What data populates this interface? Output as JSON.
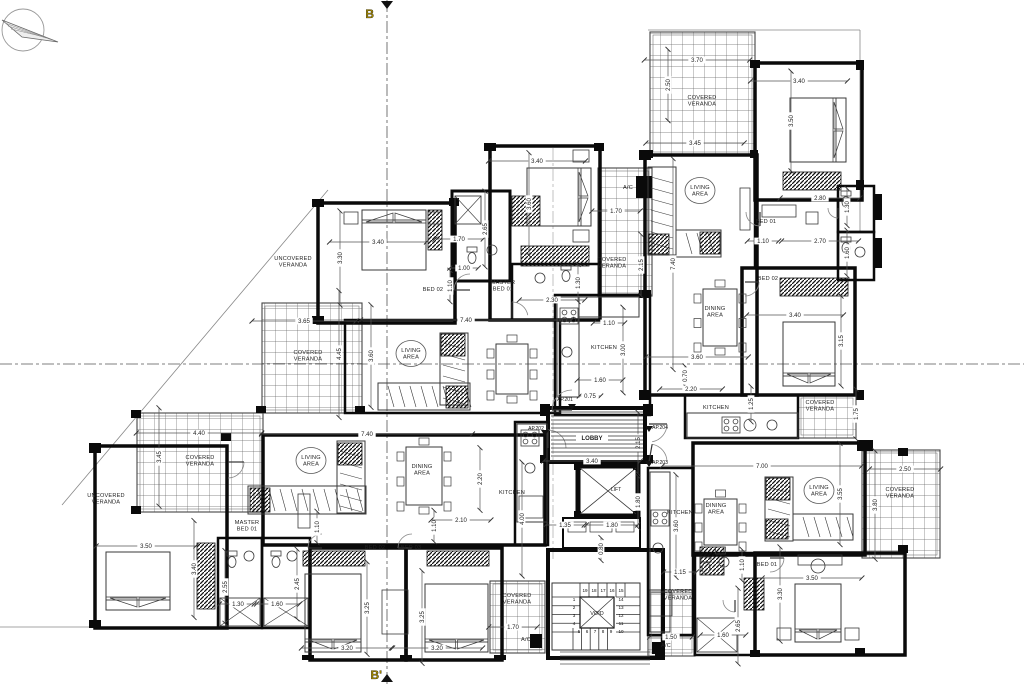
{
  "drawing": {
    "type": "apartment-building-floor-plan",
    "colors": {
      "paper": "#ffffff",
      "wall": "#0a0a0a",
      "furniture": "#3a3a3a",
      "grid": "#666666",
      "dim_line": "#555555",
      "label": "#222222",
      "section_marker": "#a58a00"
    },
    "section": {
      "top": "B",
      "bottom": "B'"
    },
    "compass": {
      "name": "north-arrow"
    },
    "core": {
      "lobby": "LOBBY",
      "lift": "LIFT",
      "void": "VOID"
    },
    "stair_steps": [
      {
        "n": "1",
        "x": 574,
        "y": 601
      },
      {
        "n": "2",
        "x": 574,
        "y": 609
      },
      {
        "n": "3",
        "x": 574,
        "y": 617
      },
      {
        "n": "4",
        "x": 574,
        "y": 625
      },
      {
        "n": "5",
        "x": 579,
        "y": 633
      },
      {
        "n": "6",
        "x": 587,
        "y": 633
      },
      {
        "n": "7",
        "x": 595,
        "y": 633
      },
      {
        "n": "8",
        "x": 603,
        "y": 633
      },
      {
        "n": "9",
        "x": 611,
        "y": 633
      },
      {
        "n": "10",
        "x": 621,
        "y": 633
      },
      {
        "n": "11",
        "x": 621,
        "y": 625
      },
      {
        "n": "12",
        "x": 621,
        "y": 617
      },
      {
        "n": "13",
        "x": 621,
        "y": 609
      },
      {
        "n": "14",
        "x": 621,
        "y": 601
      },
      {
        "n": "15",
        "x": 621,
        "y": 592
      },
      {
        "n": "16",
        "x": 612,
        "y": 592
      },
      {
        "n": "17",
        "x": 603,
        "y": 592
      },
      {
        "n": "18",
        "x": 594,
        "y": 592
      },
      {
        "n": "19",
        "x": 585,
        "y": 592
      }
    ],
    "apartment_doors": [
      {
        "t": "AP.201",
        "x": 565,
        "y": 401,
        "mx": 572,
        "my": 404
      },
      {
        "t": "AP.202",
        "x": 536,
        "y": 430,
        "mx": 545,
        "my": 430
      },
      {
        "t": "AP.204",
        "x": 660,
        "y": 429,
        "mx": 649,
        "my": 426
      },
      {
        "t": "AP.203",
        "x": 660,
        "y": 464,
        "mx": 649,
        "my": 461
      }
    ],
    "room_labels": [
      {
        "lines": [
          "UNCOVERED",
          "VERANDA"
        ],
        "x": 293,
        "y": 260
      },
      {
        "lines": [
          "COVERED",
          "VERANDA"
        ],
        "x": 308,
        "y": 354
      },
      {
        "lines": [
          "LIVING",
          "AREA"
        ],
        "x": 411,
        "y": 352,
        "oval": true
      },
      {
        "lines": [
          "MASTER",
          "BED 01"
        ],
        "x": 503,
        "y": 284
      },
      {
        "lines": [
          "BED 02"
        ],
        "x": 433,
        "y": 291
      },
      {
        "lines": [
          "COVERED",
          "VERANDA"
        ],
        "x": 612,
        "y": 261
      },
      {
        "lines": [
          "A/C"
        ],
        "x": 628,
        "y": 189
      },
      {
        "lines": [
          "COVERED",
          "VERANDA"
        ],
        "x": 702,
        "y": 99
      },
      {
        "lines": [
          "LIVING",
          "AREA"
        ],
        "x": 700,
        "y": 189,
        "oval": true
      },
      {
        "lines": [
          "BED 01"
        ],
        "x": 766,
        "y": 223
      },
      {
        "lines": [
          "BED 02"
        ],
        "x": 768,
        "y": 280
      },
      {
        "lines": [
          "DINING",
          "AREA"
        ],
        "x": 715,
        "y": 310
      },
      {
        "lines": [
          "KITCHEN"
        ],
        "x": 716,
        "y": 409
      },
      {
        "lines": [
          "COVERED",
          "VERANDA"
        ],
        "x": 820,
        "y": 404
      },
      {
        "lines": [
          "KITCHEN"
        ],
        "x": 604,
        "y": 349
      },
      {
        "lines": [
          "MASTER",
          "BED 01"
        ],
        "x": 247,
        "y": 524
      },
      {
        "lines": [
          "COVERED",
          "VERANDA"
        ],
        "x": 200,
        "y": 459
      },
      {
        "lines": [
          "UNCOVERED",
          "VERANDA"
        ],
        "x": 106,
        "y": 497
      },
      {
        "lines": [
          "LIVING",
          "AREA"
        ],
        "x": 311,
        "y": 459,
        "oval": true
      },
      {
        "lines": [
          "DINING",
          "AREA"
        ],
        "x": 422,
        "y": 468
      },
      {
        "lines": [
          "KITCHEN"
        ],
        "x": 512,
        "y": 494
      },
      {
        "lines": [
          "BED 02"
        ],
        "x": 375,
        "y": 549
      },
      {
        "lines": [
          "BED 03"
        ],
        "x": 411,
        "y": 549
      },
      {
        "lines": [
          "KITCHEN"
        ],
        "x": 680,
        "y": 514
      },
      {
        "lines": [
          "DINING",
          "AREA"
        ],
        "x": 716,
        "y": 507
      },
      {
        "lines": [
          "LIVING",
          "AREA"
        ],
        "x": 819,
        "y": 489,
        "oval": true
      },
      {
        "lines": [
          "BED 01"
        ],
        "x": 767,
        "y": 566
      },
      {
        "lines": [
          "COVERED",
          "VERANDA"
        ],
        "x": 678,
        "y": 593
      },
      {
        "lines": [
          "COVERED",
          "VERANDA"
        ],
        "x": 517,
        "y": 597
      },
      {
        "lines": [
          "COVERED",
          "VERANDA"
        ],
        "x": 900,
        "y": 491
      },
      {
        "lines": [
          "A/C"
        ],
        "x": 666,
        "y": 647
      },
      {
        "lines": [
          "A/C"
        ],
        "x": 526,
        "y": 641
      }
    ],
    "dimensions": [
      {
        "t": "3.40",
        "x": 378,
        "y": 242
      },
      {
        "t": "3.30",
        "x": 340,
        "y": 258,
        "v": 1
      },
      {
        "t": "1.70",
        "x": 459,
        "y": 239
      },
      {
        "t": "2.65",
        "x": 485,
        "y": 229,
        "v": 1
      },
      {
        "t": "1.00",
        "x": 464,
        "y": 268
      },
      {
        "t": "1.10",
        "x": 450,
        "y": 286,
        "v": 1
      },
      {
        "t": "3.40",
        "x": 537,
        "y": 161
      },
      {
        "t": "3.60",
        "x": 529,
        "y": 204,
        "v": 1
      },
      {
        "t": "1.30",
        "x": 578,
        "y": 283,
        "v": 1
      },
      {
        "t": "2.30",
        "x": 552,
        "y": 300
      },
      {
        "t": "1.70",
        "x": 616,
        "y": 211
      },
      {
        "t": "2.15",
        "x": 641,
        "y": 265,
        "v": 1
      },
      {
        "t": "3.65",
        "x": 304,
        "y": 321
      },
      {
        "t": "4.45",
        "x": 339,
        "y": 354,
        "v": 1
      },
      {
        "t": "7.40",
        "x": 466,
        "y": 320
      },
      {
        "t": "3.60",
        "x": 371,
        "y": 356,
        "v": 1
      },
      {
        "t": "1.10",
        "x": 609,
        "y": 323
      },
      {
        "t": "3.00",
        "x": 623,
        "y": 350,
        "v": 1
      },
      {
        "t": "1.60",
        "x": 600,
        "y": 380
      },
      {
        "t": "0.75",
        "x": 590,
        "y": 396
      },
      {
        "t": "3.70",
        "x": 697,
        "y": 60
      },
      {
        "t": "2.50",
        "x": 668,
        "y": 85,
        "v": 1
      },
      {
        "t": "3.45",
        "x": 695,
        "y": 143
      },
      {
        "t": "3.40",
        "x": 799,
        "y": 81
      },
      {
        "t": "3.50",
        "x": 791,
        "y": 121,
        "v": 1
      },
      {
        "t": "2.80",
        "x": 820,
        "y": 198
      },
      {
        "t": "1.30",
        "x": 847,
        "y": 207,
        "v": 1
      },
      {
        "t": "1.10",
        "x": 763,
        "y": 241
      },
      {
        "t": "2.70",
        "x": 820,
        "y": 241
      },
      {
        "t": "1.60",
        "x": 847,
        "y": 253,
        "v": 1
      },
      {
        "t": "3.40",
        "x": 795,
        "y": 315
      },
      {
        "t": "3.15",
        "x": 841,
        "y": 341,
        "v": 1
      },
      {
        "t": "7.40",
        "x": 673,
        "y": 264,
        "v": 1
      },
      {
        "t": "3.60",
        "x": 697,
        "y": 357
      },
      {
        "t": "0.70",
        "x": 685,
        "y": 376,
        "v": 1
      },
      {
        "t": "2.20",
        "x": 691,
        "y": 389
      },
      {
        "t": "1.25",
        "x": 751,
        "y": 404,
        "v": 1
      },
      {
        "t": "1.75",
        "x": 856,
        "y": 414,
        "v": 1
      },
      {
        "t": "3.40",
        "x": 592,
        "y": 461
      },
      {
        "t": "2.15",
        "x": 638,
        "y": 443,
        "v": 1
      },
      {
        "t": "1.35",
        "x": 565,
        "y": 525
      },
      {
        "t": "1.80",
        "x": 612,
        "y": 525
      },
      {
        "t": "1.80",
        "x": 638,
        "y": 502,
        "v": 1
      },
      {
        "t": "0.80",
        "x": 601,
        "y": 549,
        "v": 1
      },
      {
        "t": "4.40",
        "x": 199,
        "y": 433
      },
      {
        "t": "3.45",
        "x": 159,
        "y": 457,
        "v": 1
      },
      {
        "t": "7.40",
        "x": 367,
        "y": 434
      },
      {
        "t": "3.50",
        "x": 146,
        "y": 546
      },
      {
        "t": "3.40",
        "x": 194,
        "y": 569,
        "v": 1
      },
      {
        "t": "2.55",
        "x": 225,
        "y": 587,
        "v": 1
      },
      {
        "t": "1.30",
        "x": 238,
        "y": 604
      },
      {
        "t": "2.45",
        "x": 297,
        "y": 584,
        "v": 1
      },
      {
        "t": "1.60",
        "x": 277,
        "y": 604
      },
      {
        "t": "1.10",
        "x": 317,
        "y": 527,
        "v": 1
      },
      {
        "t": "1.10",
        "x": 434,
        "y": 526,
        "v": 1
      },
      {
        "t": "2.10",
        "x": 461,
        "y": 520
      },
      {
        "t": "3.25",
        "x": 367,
        "y": 608,
        "v": 1
      },
      {
        "t": "3.20",
        "x": 347,
        "y": 648
      },
      {
        "t": "3.25",
        "x": 422,
        "y": 617,
        "v": 1
      },
      {
        "t": "3.20",
        "x": 437,
        "y": 648
      },
      {
        "t": "2.20",
        "x": 480,
        "y": 479,
        "v": 1
      },
      {
        "t": "4.00",
        "x": 522,
        "y": 519,
        "v": 1
      },
      {
        "t": "7.00",
        "x": 762,
        "y": 466
      },
      {
        "t": "3.55",
        "x": 840,
        "y": 494,
        "v": 1
      },
      {
        "t": "3.60",
        "x": 676,
        "y": 526,
        "v": 1
      },
      {
        "t": "1.15",
        "x": 680,
        "y": 572
      },
      {
        "t": "1.10",
        "x": 742,
        "y": 565,
        "v": 1
      },
      {
        "t": "2.65",
        "x": 738,
        "y": 626,
        "v": 1
      },
      {
        "t": "1.60",
        "x": 723,
        "y": 635
      },
      {
        "t": "3.50",
        "x": 812,
        "y": 578
      },
      {
        "t": "3.30",
        "x": 780,
        "y": 594,
        "v": 1
      },
      {
        "t": "1.50",
        "x": 671,
        "y": 637
      },
      {
        "t": "1.70",
        "x": 513,
        "y": 627
      },
      {
        "t": "2.50",
        "x": 905,
        "y": 469
      },
      {
        "t": "3.80",
        "x": 875,
        "y": 505,
        "v": 1
      }
    ]
  }
}
